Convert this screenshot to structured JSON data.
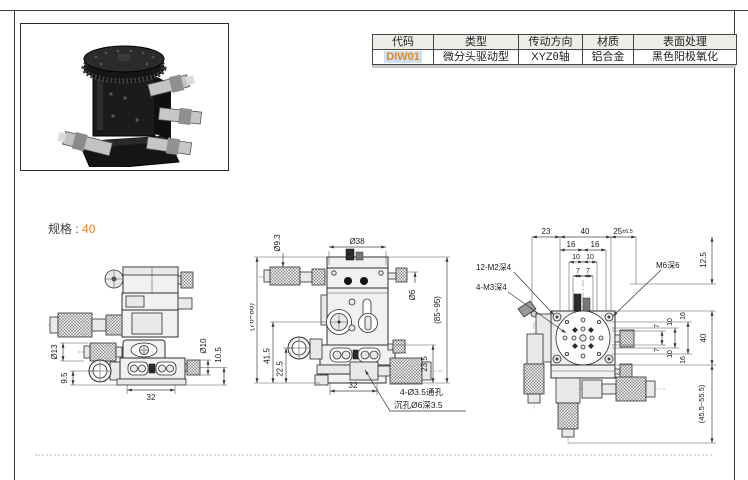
{
  "spec": {
    "label": "规格",
    "sep": ":",
    "value": "40"
  },
  "table": {
    "headers": [
      "代码",
      "类型",
      "传动方向",
      "材质",
      "表面处理"
    ],
    "row": [
      "DIW01",
      "微分头驱动型",
      "XYZθ轴",
      "铝合金",
      "黑色阳极氧化"
    ]
  },
  "drawings": {
    "side": {
      "dia13": "Ø13",
      "h9_5": "9.5",
      "w32": "32",
      "dia10": "Ø10",
      "h10_5": "10.5"
    },
    "front": {
      "dia9_3": "Ø9.3",
      "dia38": "Ø38",
      "dia6": "Ø6",
      "range_left": "(76~86)",
      "h41_5": "41.5",
      "h22_5": "22.5",
      "range_right": "(85~95)",
      "h23_5": "23.5",
      "w32": "32",
      "note1": "4-Ø3.5通孔",
      "note2": "沉孔Ø6深3.5"
    },
    "top": {
      "w23": "23",
      "w40": "40",
      "w25": "25",
      "w25tol": "±6.5",
      "t16l": "16",
      "t16r": "16",
      "t10l": "10",
      "t10r": "10",
      "t7l": "7",
      "t7r": "7",
      "m2": "12-M2深4",
      "m3": "4-M3深4",
      "m6": "M6深6",
      "h12_5": "12.5",
      "r7t": "7",
      "r7b": "7",
      "r10t": "10",
      "r10b": "10",
      "r16t": "16",
      "r16b": "16",
      "r40": "40",
      "range_bottom": "(45.5~55.5)"
    }
  },
  "colors": {
    "accent": "#ed7f16",
    "code_text": "#e8891f",
    "code_bg": "#cfe0f2",
    "header_bg": "#edece7"
  }
}
